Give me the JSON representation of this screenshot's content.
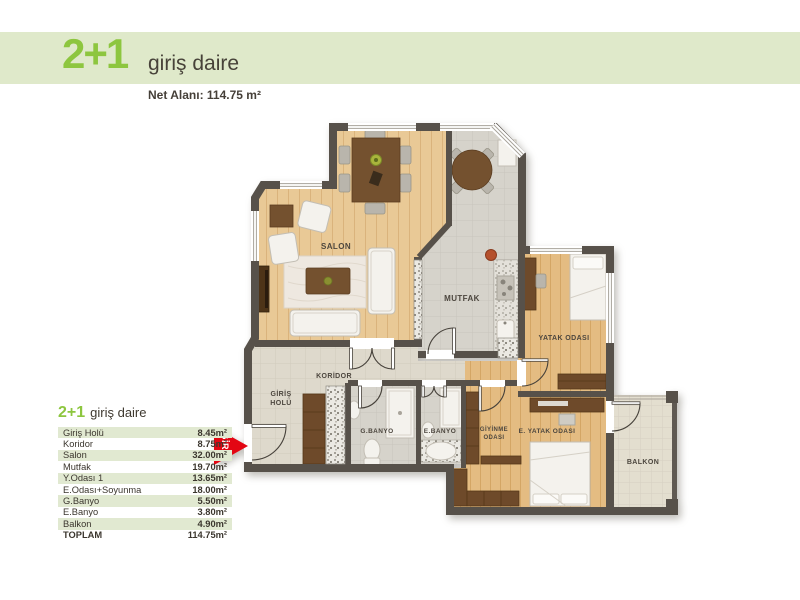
{
  "header": {
    "unit_type": "2+1",
    "unit_name": "giriş daire",
    "net_area": "Net Alanı: 114.75 m²"
  },
  "area_table": {
    "title_type": "2+1",
    "title_name": "giriş daire",
    "rows": [
      {
        "name": "Giriş Holü",
        "area": "8.45m²"
      },
      {
        "name": "Koridor",
        "area": "8.75m²"
      },
      {
        "name": "Salon",
        "area": "32.00m²"
      },
      {
        "name": "Mutfak",
        "area": "19.70m²"
      },
      {
        "name": "Y.Odası 1",
        "area": "13.65m²"
      },
      {
        "name": "E.Odası+Soyunma",
        "area": "18.00m²"
      },
      {
        "name": "G.Banyo",
        "area": "5.50m²"
      },
      {
        "name": "E.Banyo",
        "area": "3.80m²"
      },
      {
        "name": "Balkon",
        "area": "4.90m²"
      },
      {
        "name": "TOPLAM",
        "area": "114.75m²"
      }
    ]
  },
  "floor_plan": {
    "labels": {
      "salon": "SALON",
      "mutfak": "MUTFAK",
      "koridor": "KORİDOR",
      "giris_holu_1": "GİRİŞ",
      "giris_holu_2": "HOLÜ",
      "g_banyo": "G.BANYO",
      "e_banyo": "E.BANYO",
      "giyinme_1": "GİYİNME",
      "giyinme_2": "ODASI",
      "e_yatak": "E. YATAK ODASI",
      "yatak": "YATAK ODASI",
      "balkon": "BALKON"
    },
    "entrance_label": "GİRİŞ"
  },
  "colors": {
    "accent_green": "#8dc63f",
    "band_green": "#dfe9ca",
    "entrance_red": "#e30613",
    "wall": "#57514a"
  }
}
